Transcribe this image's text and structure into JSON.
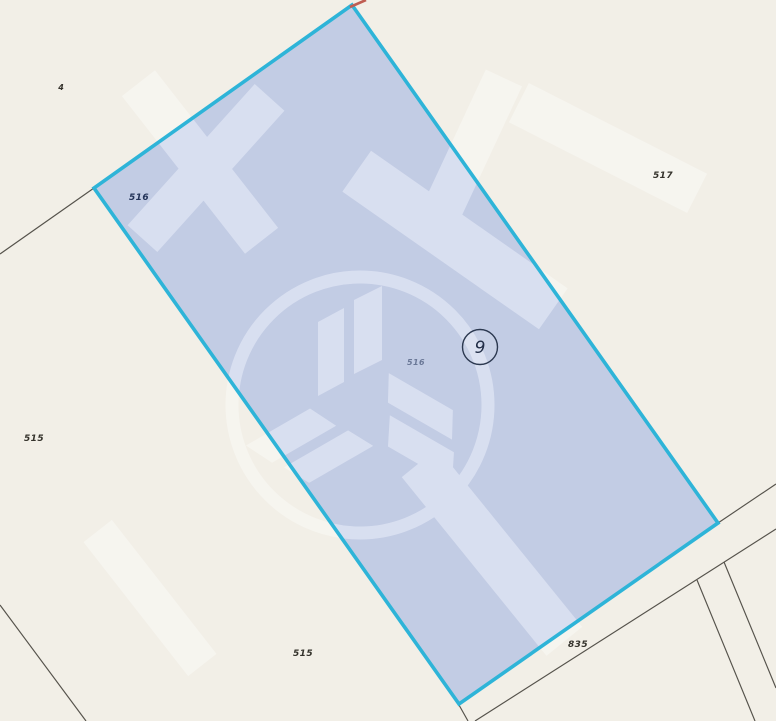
{
  "map": {
    "type": "cadastral-parcel-map",
    "selection": {
      "parcel_number": "516",
      "marker_value": "9"
    },
    "labels": [
      {
        "name": "parcel-label-4",
        "text": "4"
      },
      {
        "name": "parcel-label-516",
        "text": "516"
      },
      {
        "name": "parcel-label-517",
        "text": "517"
      },
      {
        "name": "parcel-label-515-west",
        "text": "515"
      },
      {
        "name": "parcel-label-516-center",
        "text": "516"
      },
      {
        "name": "parcel-label-515-south",
        "text": "515"
      },
      {
        "name": "parcel-label-835",
        "text": "835"
      }
    ],
    "watermark": {
      "name": "hb-monogram-logo-watermark"
    },
    "colors": {
      "background": "#f2efe7",
      "selection_fill": "#c5cfe8",
      "selection_border": "#2eb4d8",
      "boundary_line": "#55524b",
      "label_outside": "#34322b",
      "label_inside": "#233358",
      "marker_ring": "#2c3950",
      "watermark": "#ffffff",
      "apex_tick_red": "#bf5d52"
    }
  }
}
